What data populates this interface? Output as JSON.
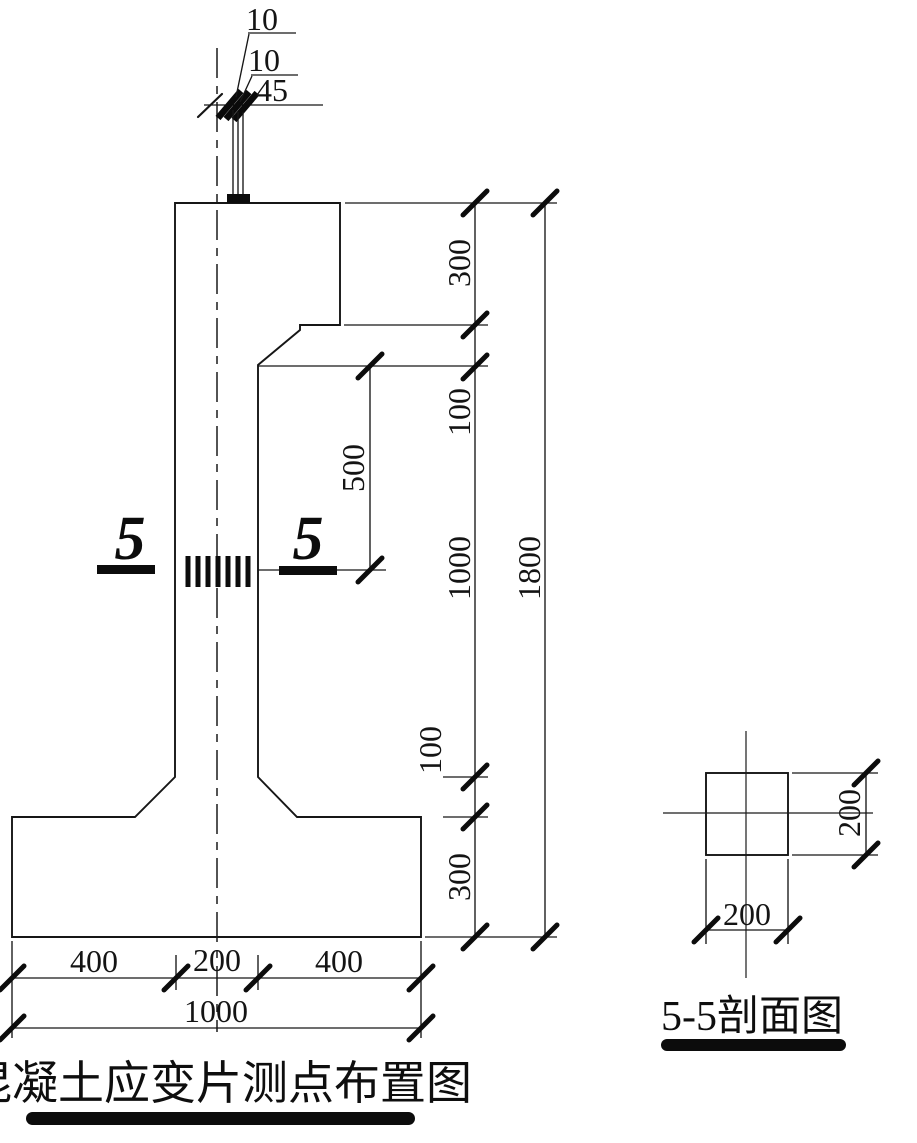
{
  "figure": {
    "main_caption": "混凝土应变片测点布置图",
    "section_caption": "5-5剖面图",
    "section_marker_left": "5",
    "section_marker_right": "5"
  },
  "dimensions": {
    "top_detail": {
      "labels": [
        "10",
        "10",
        "45"
      ]
    },
    "gauge_offset": "500",
    "right_chain": {
      "segments": [
        "300",
        "100",
        "1000",
        "100",
        "300"
      ],
      "total": "1800"
    },
    "bottom_chain": {
      "segments": [
        "400",
        "200",
        "400"
      ],
      "total": "1000"
    },
    "section": {
      "width": "200",
      "height": "200"
    }
  },
  "colors": {
    "ink": "#141414",
    "background": "#ffffff"
  }
}
